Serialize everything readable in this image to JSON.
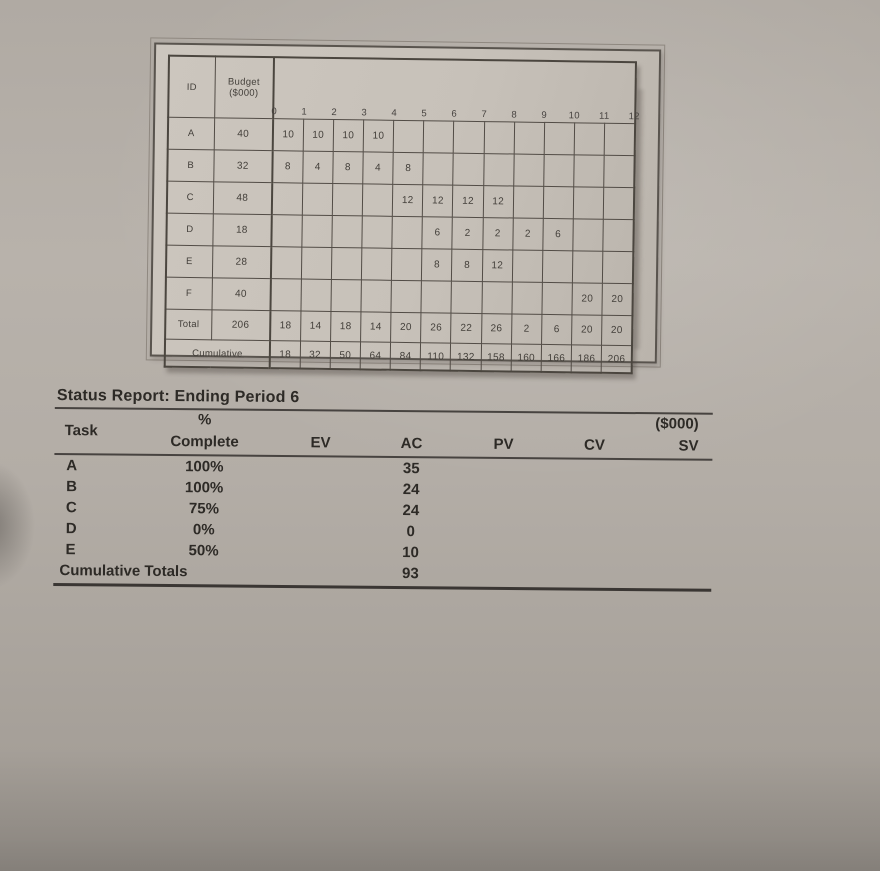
{
  "figure": {
    "header": {
      "id": "ID",
      "budget_line1": "Budget",
      "budget_line2": "($000)"
    },
    "timeline_ticks": [
      "0",
      "1",
      "2",
      "3",
      "4",
      "5",
      "6",
      "7",
      "8",
      "9",
      "10",
      "11",
      "12"
    ],
    "task_rows": [
      {
        "id": "A",
        "budget": "40",
        "periods": [
          "10",
          "10",
          "10",
          "10",
          "",
          "",
          "",
          "",
          "",
          "",
          "",
          ""
        ]
      },
      {
        "id": "B",
        "budget": "32",
        "periods": [
          "8",
          "4",
          "8",
          "4",
          "8",
          "",
          "",
          "",
          "",
          "",
          "",
          ""
        ]
      },
      {
        "id": "C",
        "budget": "48",
        "periods": [
          "",
          "",
          "",
          "",
          "12",
          "12",
          "12",
          "12",
          "",
          "",
          "",
          ""
        ]
      },
      {
        "id": "D",
        "budget": "18",
        "periods": [
          "",
          "",
          "",
          "",
          "",
          "6",
          "2",
          "2",
          "2",
          "6",
          "",
          ""
        ]
      },
      {
        "id": "E",
        "budget": "28",
        "periods": [
          "",
          "",
          "",
          "",
          "",
          "8",
          "8",
          "12",
          "",
          "",
          "",
          ""
        ]
      },
      {
        "id": "F",
        "budget": "40",
        "periods": [
          "",
          "",
          "",
          "",
          "",
          "",
          "",
          "",
          "",
          "",
          "20",
          "20"
        ]
      }
    ],
    "total_row": {
      "label": "Total",
      "budget": "206",
      "periods": [
        "18",
        "14",
        "18",
        "14",
        "20",
        "26",
        "22",
        "26",
        "2",
        "6",
        "20",
        "20"
      ]
    },
    "cumulative_row": {
      "label": "Cumulative",
      "periods": [
        "18",
        "32",
        "50",
        "64",
        "84",
        "110",
        "132",
        "158",
        "160",
        "166",
        "186",
        "206"
      ]
    }
  },
  "status_report": {
    "title": "Status Report: Ending Period 6",
    "unit_label": "($000)",
    "columns": {
      "task": "Task",
      "pct_symbol": "%",
      "pct_word": "Complete",
      "ev": "EV",
      "ac": "AC",
      "pv": "PV",
      "cv": "CV",
      "sv": "SV"
    },
    "rows": [
      {
        "task": "A",
        "pct_complete": "100%",
        "ev": "",
        "ac": "35",
        "pv": "",
        "cv": "",
        "sv": ""
      },
      {
        "task": "B",
        "pct_complete": "100%",
        "ev": "",
        "ac": "24",
        "pv": "",
        "cv": "",
        "sv": ""
      },
      {
        "task": "C",
        "pct_complete": "75%",
        "ev": "",
        "ac": "24",
        "pv": "",
        "cv": "",
        "sv": ""
      },
      {
        "task": "D",
        "pct_complete": "0%",
        "ev": "",
        "ac": "0",
        "pv": "",
        "cv": "",
        "sv": ""
      },
      {
        "task": "E",
        "pct_complete": "50%",
        "ev": "",
        "ac": "10",
        "pv": "",
        "cv": "",
        "sv": ""
      }
    ],
    "totals_row": {
      "label": "Cumulative Totals",
      "ev": "",
      "ac": "93",
      "pv": "",
      "cv": "",
      "sv": ""
    }
  }
}
